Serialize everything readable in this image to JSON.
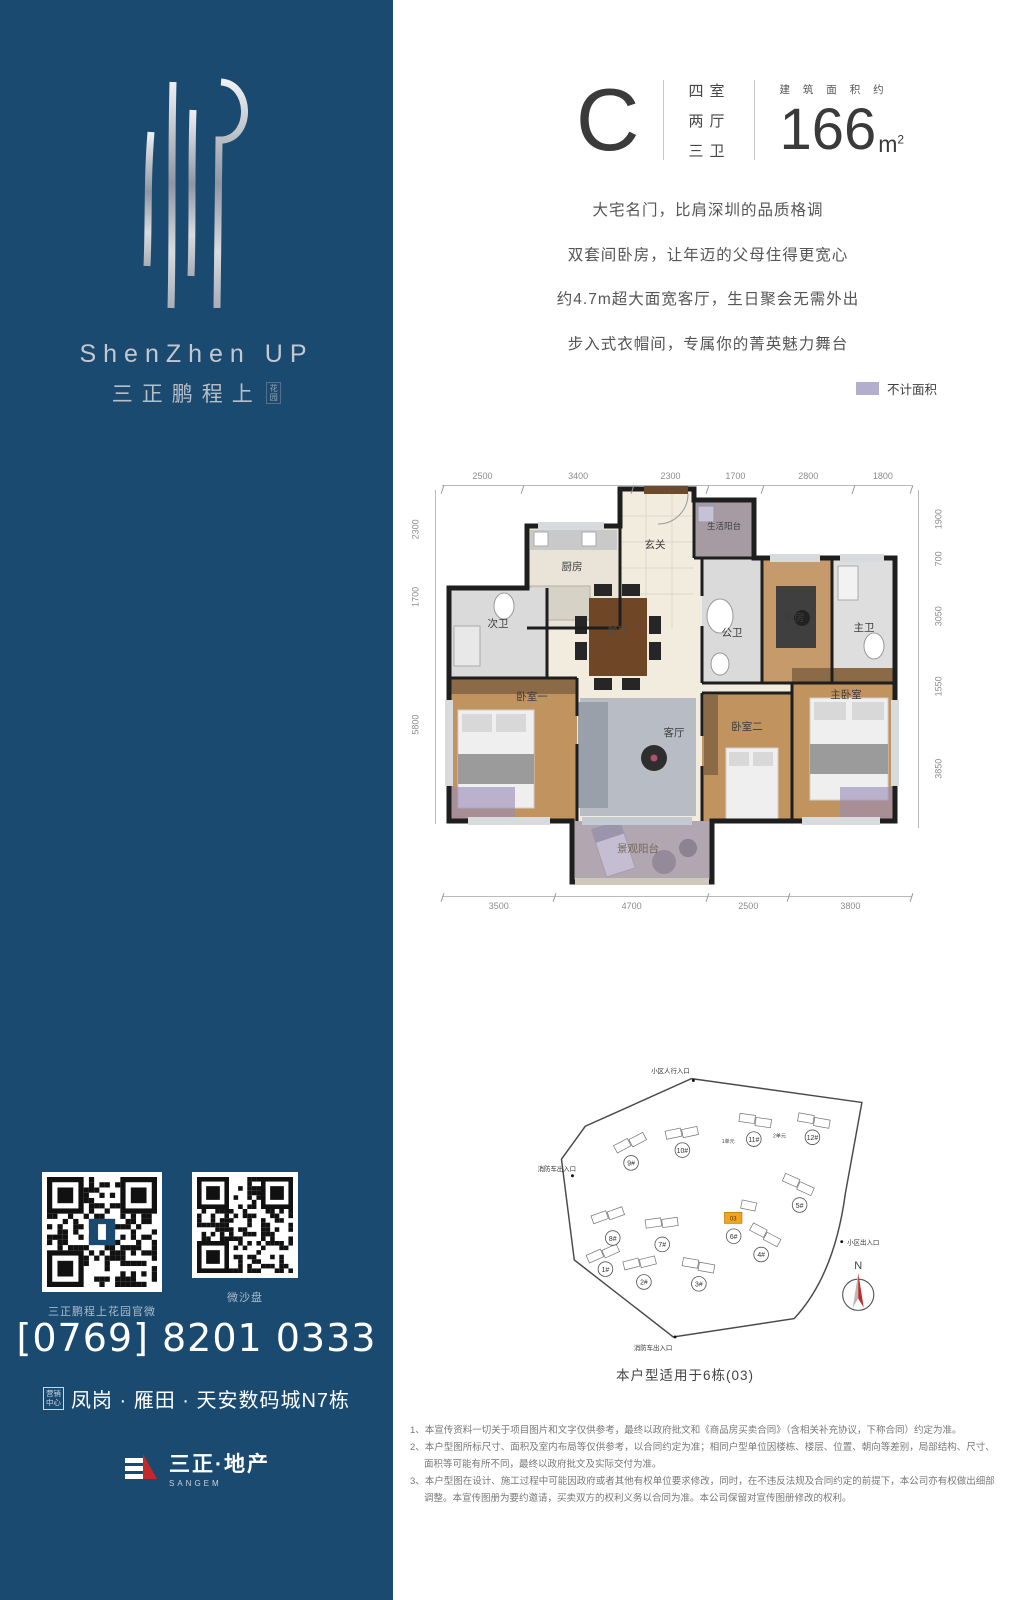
{
  "brand": {
    "logo_en": "ShenZhen UP",
    "logo_cn": "三正鹏程上",
    "logo_cn_small": "花园",
    "qr_captions": [
      "三正鹏程上花园官微",
      "微沙盘"
    ],
    "phone": "[0769] 8201 0333",
    "address_badge_l1": "营销",
    "address_badge_l2": "中心",
    "address": "凤岗 · 雁田 · 天安数码城N7栋",
    "company_cn": "三正·地产",
    "company_en": "SANGEM"
  },
  "header": {
    "unit": "C",
    "rooms": [
      "四室",
      "两厅",
      "三卫"
    ],
    "area_label": "建 筑 面 积 约",
    "area_value": "166",
    "area_unit": "m",
    "area_sup": "2"
  },
  "taglines": [
    "大宅名门，比肩深圳的品质格调",
    "双套间卧房，让年迈的父母住得更宽心",
    "约4.7m超大面宽客厅，生日聚会无需外出",
    "步入式衣帽间，专属你的菁英魅力舞台"
  ],
  "legend": {
    "label": "不计面积",
    "color": "#b2aecb"
  },
  "floorplan": {
    "dims_top": [
      "2500",
      "3400",
      "2300",
      "1700",
      "2800",
      "1800"
    ],
    "dims_bottom": [
      "3500",
      "4700",
      "2500",
      "3800"
    ],
    "dims_left": [
      "2300",
      "1700",
      "5800"
    ],
    "dims_right": [
      "1900",
      "700",
      "3050",
      "1550",
      "3850"
    ],
    "rooms": [
      "玄关",
      "生活阳台",
      "厨房",
      "次卫",
      "餐厅",
      "公卫",
      "书房",
      "主卫",
      "卧室一",
      "客厅",
      "卧室二",
      "主卧室",
      "景观阳台"
    ]
  },
  "siteplan": {
    "buildings": [
      "1#",
      "2#",
      "3#",
      "4#",
      "5#",
      "6#",
      "7#",
      "8#",
      "9#",
      "10#",
      "11#",
      "12#"
    ],
    "units": [
      "1单元",
      "2单元"
    ],
    "highlight": "03",
    "entrance_top": "小区人行入口",
    "entrance_left": "消防车出入口",
    "entrance_right": "小区出入口",
    "entrance_bottom": "消防车出入口",
    "north": "N",
    "caption": "本户型适用于6栋(03)"
  },
  "disclaimers": [
    "1、本宣传资料一切关于项目图片和文字仅供参考，最终以政府批文和《商品房买卖合同》（含相关补充协议，下称合同）约定为准。",
    "2、本户型图所标尺寸、面积及室内布局等仅供参考，以合同约定为准；相同户型单位因楼栋、楼层、位置、朝向等差别，局部结构、尺寸、面积等可能有所不同，最终以政府批文及实际交付为准。",
    "3、本户型图在设计、施工过程中可能因政府或者其他有权单位要求修改，同时，在不违反法规及合同约定的前提下，本公司亦有权做出细部调整。本宣传图册为要约邀请，买卖双方的权利义务以合同为准。本公司保留对宣传图册修改的权利。"
  ]
}
